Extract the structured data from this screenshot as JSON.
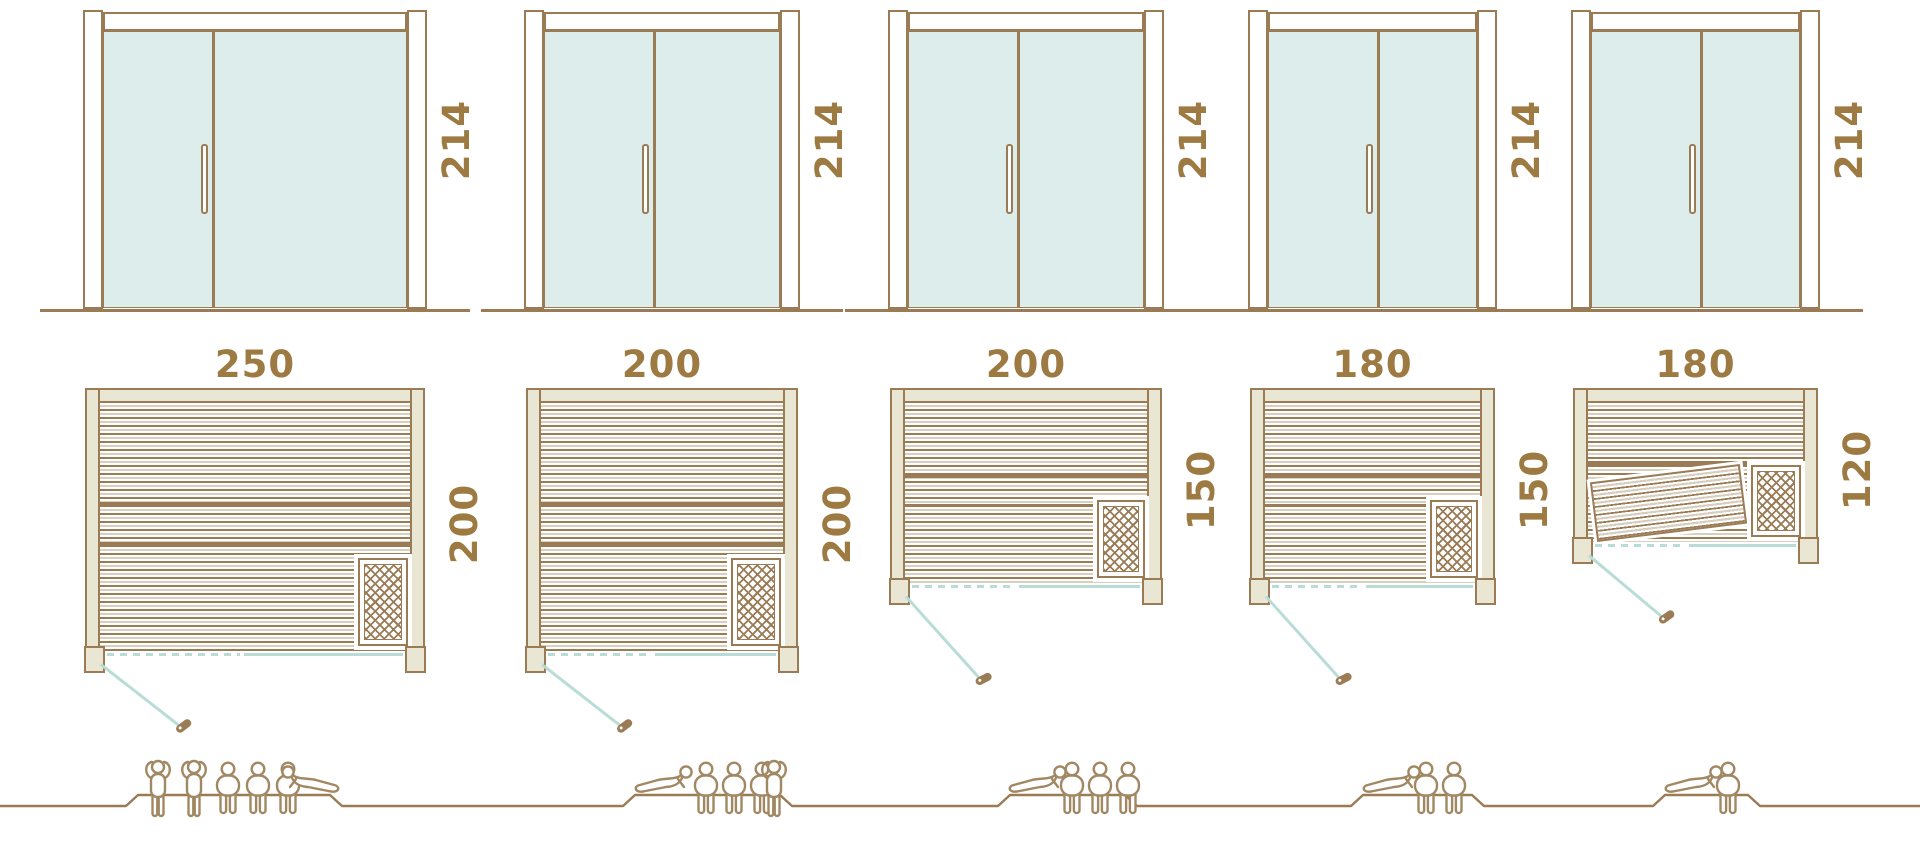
{
  "palette": {
    "line_brown": "#9a7b54",
    "label_brown": "#9c7a42",
    "wall_beige": "#eae6d4",
    "slat_beige": "#d9cfc1",
    "glass_teal": "#ddedeb",
    "door_teal": "#b9dcd8",
    "people_brown": "#a18863",
    "background": "#ffffff"
  },
  "saunas": [
    {
      "name": "sauna-250x200",
      "door_height_label": "214",
      "width_label": "250",
      "depth_label": "200",
      "width_cm": 250,
      "depth_cm": 200,
      "door_height_cm": 214,
      "capacity": 6,
      "people": [
        "standing",
        "standing",
        "sitting",
        "sitting",
        "sitting",
        "reclining"
      ],
      "tilted_bench": false
    },
    {
      "name": "sauna-200x200",
      "door_height_label": "214",
      "width_label": "200",
      "depth_label": "200",
      "width_cm": 200,
      "depth_cm": 200,
      "door_height_cm": 214,
      "capacity": 5,
      "people": [
        "reclining",
        "sitting",
        "sitting",
        "sitting",
        "standing"
      ],
      "tilted_bench": false
    },
    {
      "name": "sauna-200x150",
      "door_height_label": "214",
      "width_label": "200",
      "depth_label": "150",
      "width_cm": 200,
      "depth_cm": 150,
      "door_height_cm": 214,
      "capacity": 4,
      "people": [
        "reclining",
        "sitting",
        "sitting",
        "sitting"
      ],
      "tilted_bench": false
    },
    {
      "name": "sauna-180x150",
      "door_height_label": "214",
      "width_label": "180",
      "depth_label": "150",
      "width_cm": 180,
      "depth_cm": 150,
      "door_height_cm": 214,
      "capacity": 3,
      "people": [
        "reclining",
        "sitting",
        "sitting"
      ],
      "tilted_bench": false
    },
    {
      "name": "sauna-180x120",
      "door_height_label": "214",
      "width_label": "180",
      "depth_label": "120",
      "width_cm": 180,
      "depth_cm": 120,
      "door_height_cm": 214,
      "capacity": 2,
      "people": [
        "reclining",
        "sitting"
      ],
      "tilted_bench": true
    }
  ]
}
